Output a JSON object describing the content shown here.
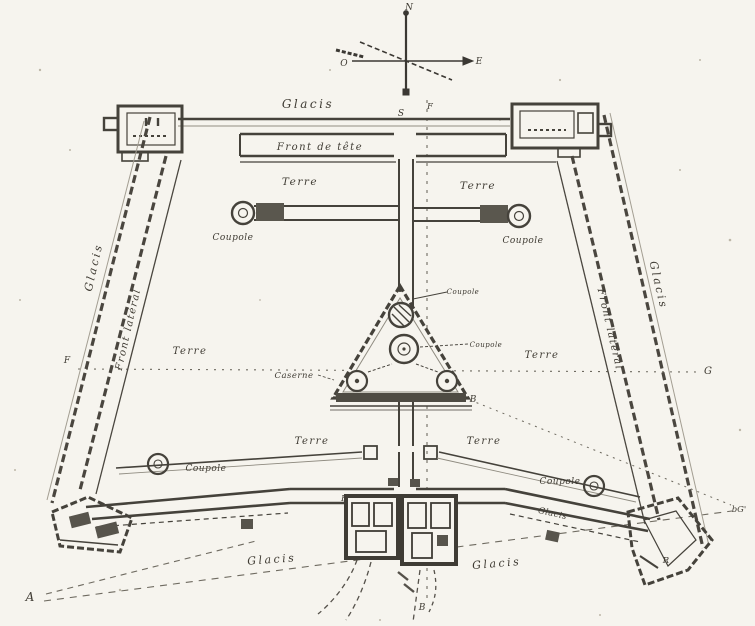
{
  "compass": {
    "north": "N",
    "south": "S",
    "west": "O",
    "east": "E",
    "capital_top": "F"
  },
  "labels": {
    "glacis_top": "Glacis",
    "glacis_left": "Glacis",
    "glacis_right": "Glacis",
    "glacis_bottom_left": "Glacis",
    "glacis_bottom_right": "Glacis",
    "glacis_gorge_right": "Glacis",
    "front_de_tete": "Front de tête",
    "front_lateral_left": "Front latéral",
    "front_lateral_right": "Front latéral",
    "front_de_gorge": "Front de gorge",
    "terre_upper_left": "Terre",
    "terre_upper_right": "Terre",
    "terre_mid_left": "Terre",
    "terre_mid_right": "Terre",
    "terre_lower_left": "Terre",
    "terre_lower_right": "Terre",
    "caserne": "Caserne",
    "coupole_upper_left": "Coupole",
    "coupole_upper_right": "Coupole",
    "coupole_center_top": "Coupole",
    "coupole_center_mid": "Coupole",
    "coupole_lower_left": "Coupole",
    "coupole_lower_right": "Coupole"
  },
  "markers": {
    "a_bottom_left": "A",
    "b_triangle": "B",
    "b_bottom": "B",
    "f_left": "F",
    "g_right": "G",
    "bg_right_edge": "bG'",
    "r_bastion": "R"
  }
}
